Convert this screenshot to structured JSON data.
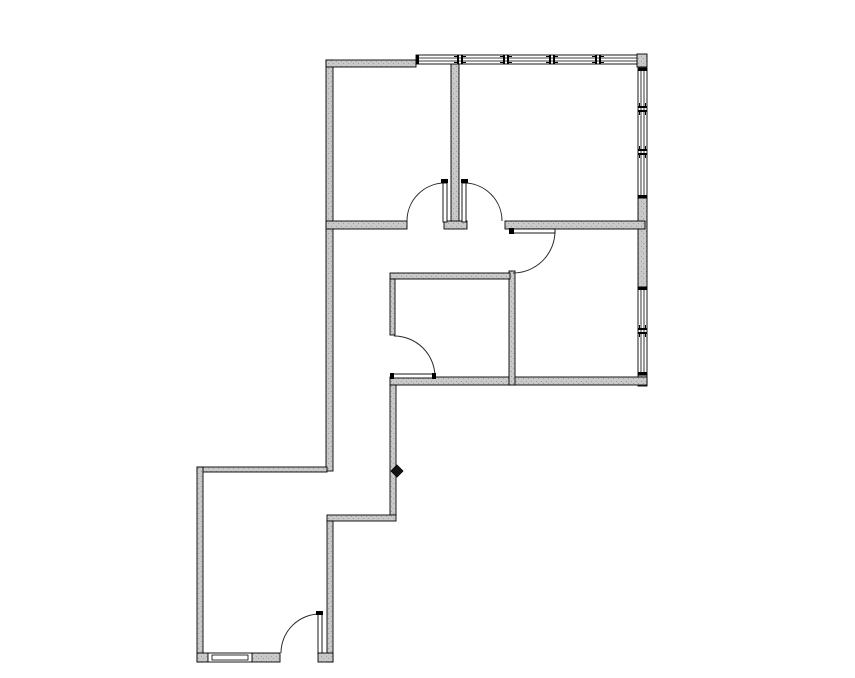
{
  "floorplan": {
    "canvas": {
      "w": 855,
      "h": 678
    },
    "style": {
      "bg": "#ffffff",
      "wall_fill": "#c9c9c9",
      "speckle": "#9e9e9e",
      "line": "#000000",
      "arc_line": "#2b2b2b",
      "window_fill": "#ffffff"
    },
    "walls": [
      {
        "name": "exterior-left-wall",
        "x": 326,
        "y": 60,
        "w": 7,
        "h": 411
      },
      {
        "name": "exterior-top-wall-segment",
        "x": 326,
        "y": 60,
        "w": 90,
        "h": 7
      },
      {
        "name": "exterior-top-right-corner",
        "x": 637,
        "y": 54,
        "w": 10,
        "h": 13
      },
      {
        "name": "exterior-right-wall-mid",
        "x": 638,
        "y": 198,
        "w": 9,
        "h": 89
      },
      {
        "name": "exterior-right-wall-corner",
        "x": 638,
        "y": 375,
        "w": 9,
        "h": 11
      },
      {
        "name": "upper-section-bottom-wall",
        "x": 390,
        "y": 377,
        "w": 257,
        "h": 8
      },
      {
        "name": "corridor-east-wall-upper",
        "x": 390,
        "y": 385,
        "w": 6,
        "h": 130
      },
      {
        "name": "corridor-jog-wall",
        "x": 327,
        "y": 515,
        "w": 69,
        "h": 6
      },
      {
        "name": "corridor-east-wall-lower",
        "x": 327,
        "y": 521,
        "w": 6,
        "h": 141
      },
      {
        "name": "lower-room-north-wall",
        "x": 197,
        "y": 467,
        "w": 130,
        "h": 5
      },
      {
        "name": "lower-room-west-wall",
        "x": 197,
        "y": 467,
        "w": 6,
        "h": 195
      },
      {
        "name": "lower-room-south-wall-a",
        "x": 197,
        "y": 653,
        "w": 11,
        "h": 9
      },
      {
        "name": "lower-room-south-wall-b",
        "x": 252,
        "y": 653,
        "w": 28,
        "h": 9
      },
      {
        "name": "lower-room-south-wall-stub",
        "x": 318,
        "y": 653,
        "w": 15,
        "h": 9
      },
      {
        "name": "upper-rooms-divider-wall",
        "x": 451,
        "y": 64,
        "w": 8,
        "h": 158
      },
      {
        "name": "hall-north-wall-left",
        "x": 326,
        "y": 221,
        "w": 81,
        "h": 8
      },
      {
        "name": "hall-north-wall-center-stub",
        "x": 444,
        "y": 221,
        "w": 23,
        "h": 8
      },
      {
        "name": "hall-north-wall-right",
        "x": 505,
        "y": 221,
        "w": 140,
        "h": 8
      },
      {
        "name": "midright-room-west-wall",
        "x": 509,
        "y": 271,
        "w": 6,
        "h": 114
      },
      {
        "name": "middle-room-north-wall",
        "x": 390,
        "y": 273,
        "w": 120,
        "h": 6
      },
      {
        "name": "middle-room-west-wall",
        "x": 390,
        "y": 279,
        "w": 5,
        "h": 56
      }
    ],
    "windows": [
      {
        "name": "window-band-top",
        "orient": "h",
        "x": 416,
        "y": 55,
        "w": 221,
        "h": 9,
        "mullions": [
          460,
          506,
          552,
          598
        ],
        "caps": [
          416
        ]
      },
      {
        "name": "window-band-right-upper",
        "orient": "v",
        "x": 638,
        "y": 68,
        "w": 9,
        "h": 130,
        "mullions": [
          109,
          152
        ],
        "caps": [
          68,
          195
        ]
      },
      {
        "name": "window-band-right-lower",
        "orient": "v",
        "x": 638,
        "y": 287,
        "w": 9,
        "h": 88,
        "mullions": [
          331
        ],
        "caps": [
          287,
          372
        ]
      },
      {
        "name": "window-lower-room-south",
        "orient": "h",
        "x": 208,
        "y": 653,
        "w": 44,
        "h": 9,
        "mullions": [],
        "caps": [],
        "inner_rect": [
          212,
          655,
          36,
          5
        ]
      }
    ],
    "doors": [
      {
        "name": "door-upper-left-room",
        "leaf": [
          443,
          183,
          4,
          39
        ],
        "caps": [
          [
            441,
            179,
            7,
            4
          ]
        ],
        "arc": "M 445 183 A 38 38 0 0 0 407 221"
      },
      {
        "name": "door-upper-right-room",
        "leaf": [
          462,
          183,
          4,
          39
        ],
        "caps": [
          [
            461,
            179,
            7,
            4
          ]
        ],
        "arc": "M 464 183 A 38 38 0 0 1 502 221"
      },
      {
        "name": "door-midright-room",
        "leaf": [
          513,
          229,
          42,
          4
        ],
        "caps": [
          [
            509,
            228,
            5,
            6
          ]
        ],
        "arc": "M 555 231 A 42 42 0 0 1 513 273"
      },
      {
        "name": "door-middle-room",
        "leaf": [
          392,
          374,
          43,
          4
        ],
        "caps": [
          [
            390,
            373,
            4,
            6
          ],
          [
            432,
            373,
            4,
            6
          ]
        ],
        "arc": "M 394 336 A 41 41 0 0 1 435 377"
      },
      {
        "name": "door-lower-room",
        "leaf": [
          318,
          614,
          4,
          39
        ],
        "caps": [
          [
            316,
            611,
            7,
            4
          ]
        ],
        "arc": "M 320 614 A 39 39 0 0 0 281 653"
      }
    ],
    "markers": [
      {
        "name": "diamond-marker",
        "points": "397,465 403,471 397,477 391,471"
      }
    ]
  }
}
